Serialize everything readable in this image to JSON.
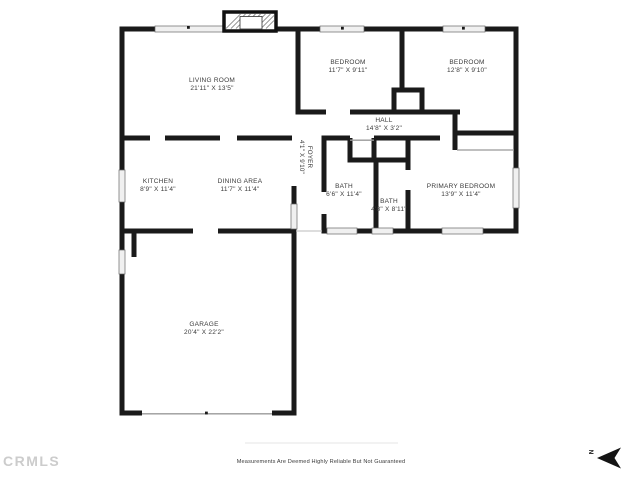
{
  "floorplan": {
    "rooms": [
      {
        "name": "LIVING ROOM",
        "dims": "21'11\" X 13'5\""
      },
      {
        "name": "BEDROOM",
        "dims": "11'7\" X 9'11\""
      },
      {
        "name": "BEDROOM",
        "dims": "12'8\" X 9'10\""
      },
      {
        "name": "HALL",
        "dims": "14'8\" X 3'2\""
      },
      {
        "name": "KITCHEN",
        "dims": "8'9\" X 11'4\""
      },
      {
        "name": "DINING AREA",
        "dims": "11'7\" X 11'4\""
      },
      {
        "name": "FOYER",
        "dims": "4'1\" X 9'10\""
      },
      {
        "name": "BATH",
        "dims": "6'6\" X 11'4\""
      },
      {
        "name": "BATH",
        "dims": "4'8\" X 8'11\""
      },
      {
        "name": "PRIMARY BEDROOM",
        "dims": "13'9\" X 11'4\""
      },
      {
        "name": "GARAGE",
        "dims": "20'4\" X 22'2\""
      }
    ],
    "compass": {
      "label": "N"
    },
    "watermark": "CRMLS",
    "disclaimer": "Measurements Are Deemed Highly Reliable But Not Guaranteed",
    "colors": {
      "wall": "#1a1a1a",
      "window_fill": "#f0f0f0",
      "text": "#3a3a3a",
      "watermark": "#cccccc",
      "disclaimer_text": "#3a3a3a"
    }
  }
}
